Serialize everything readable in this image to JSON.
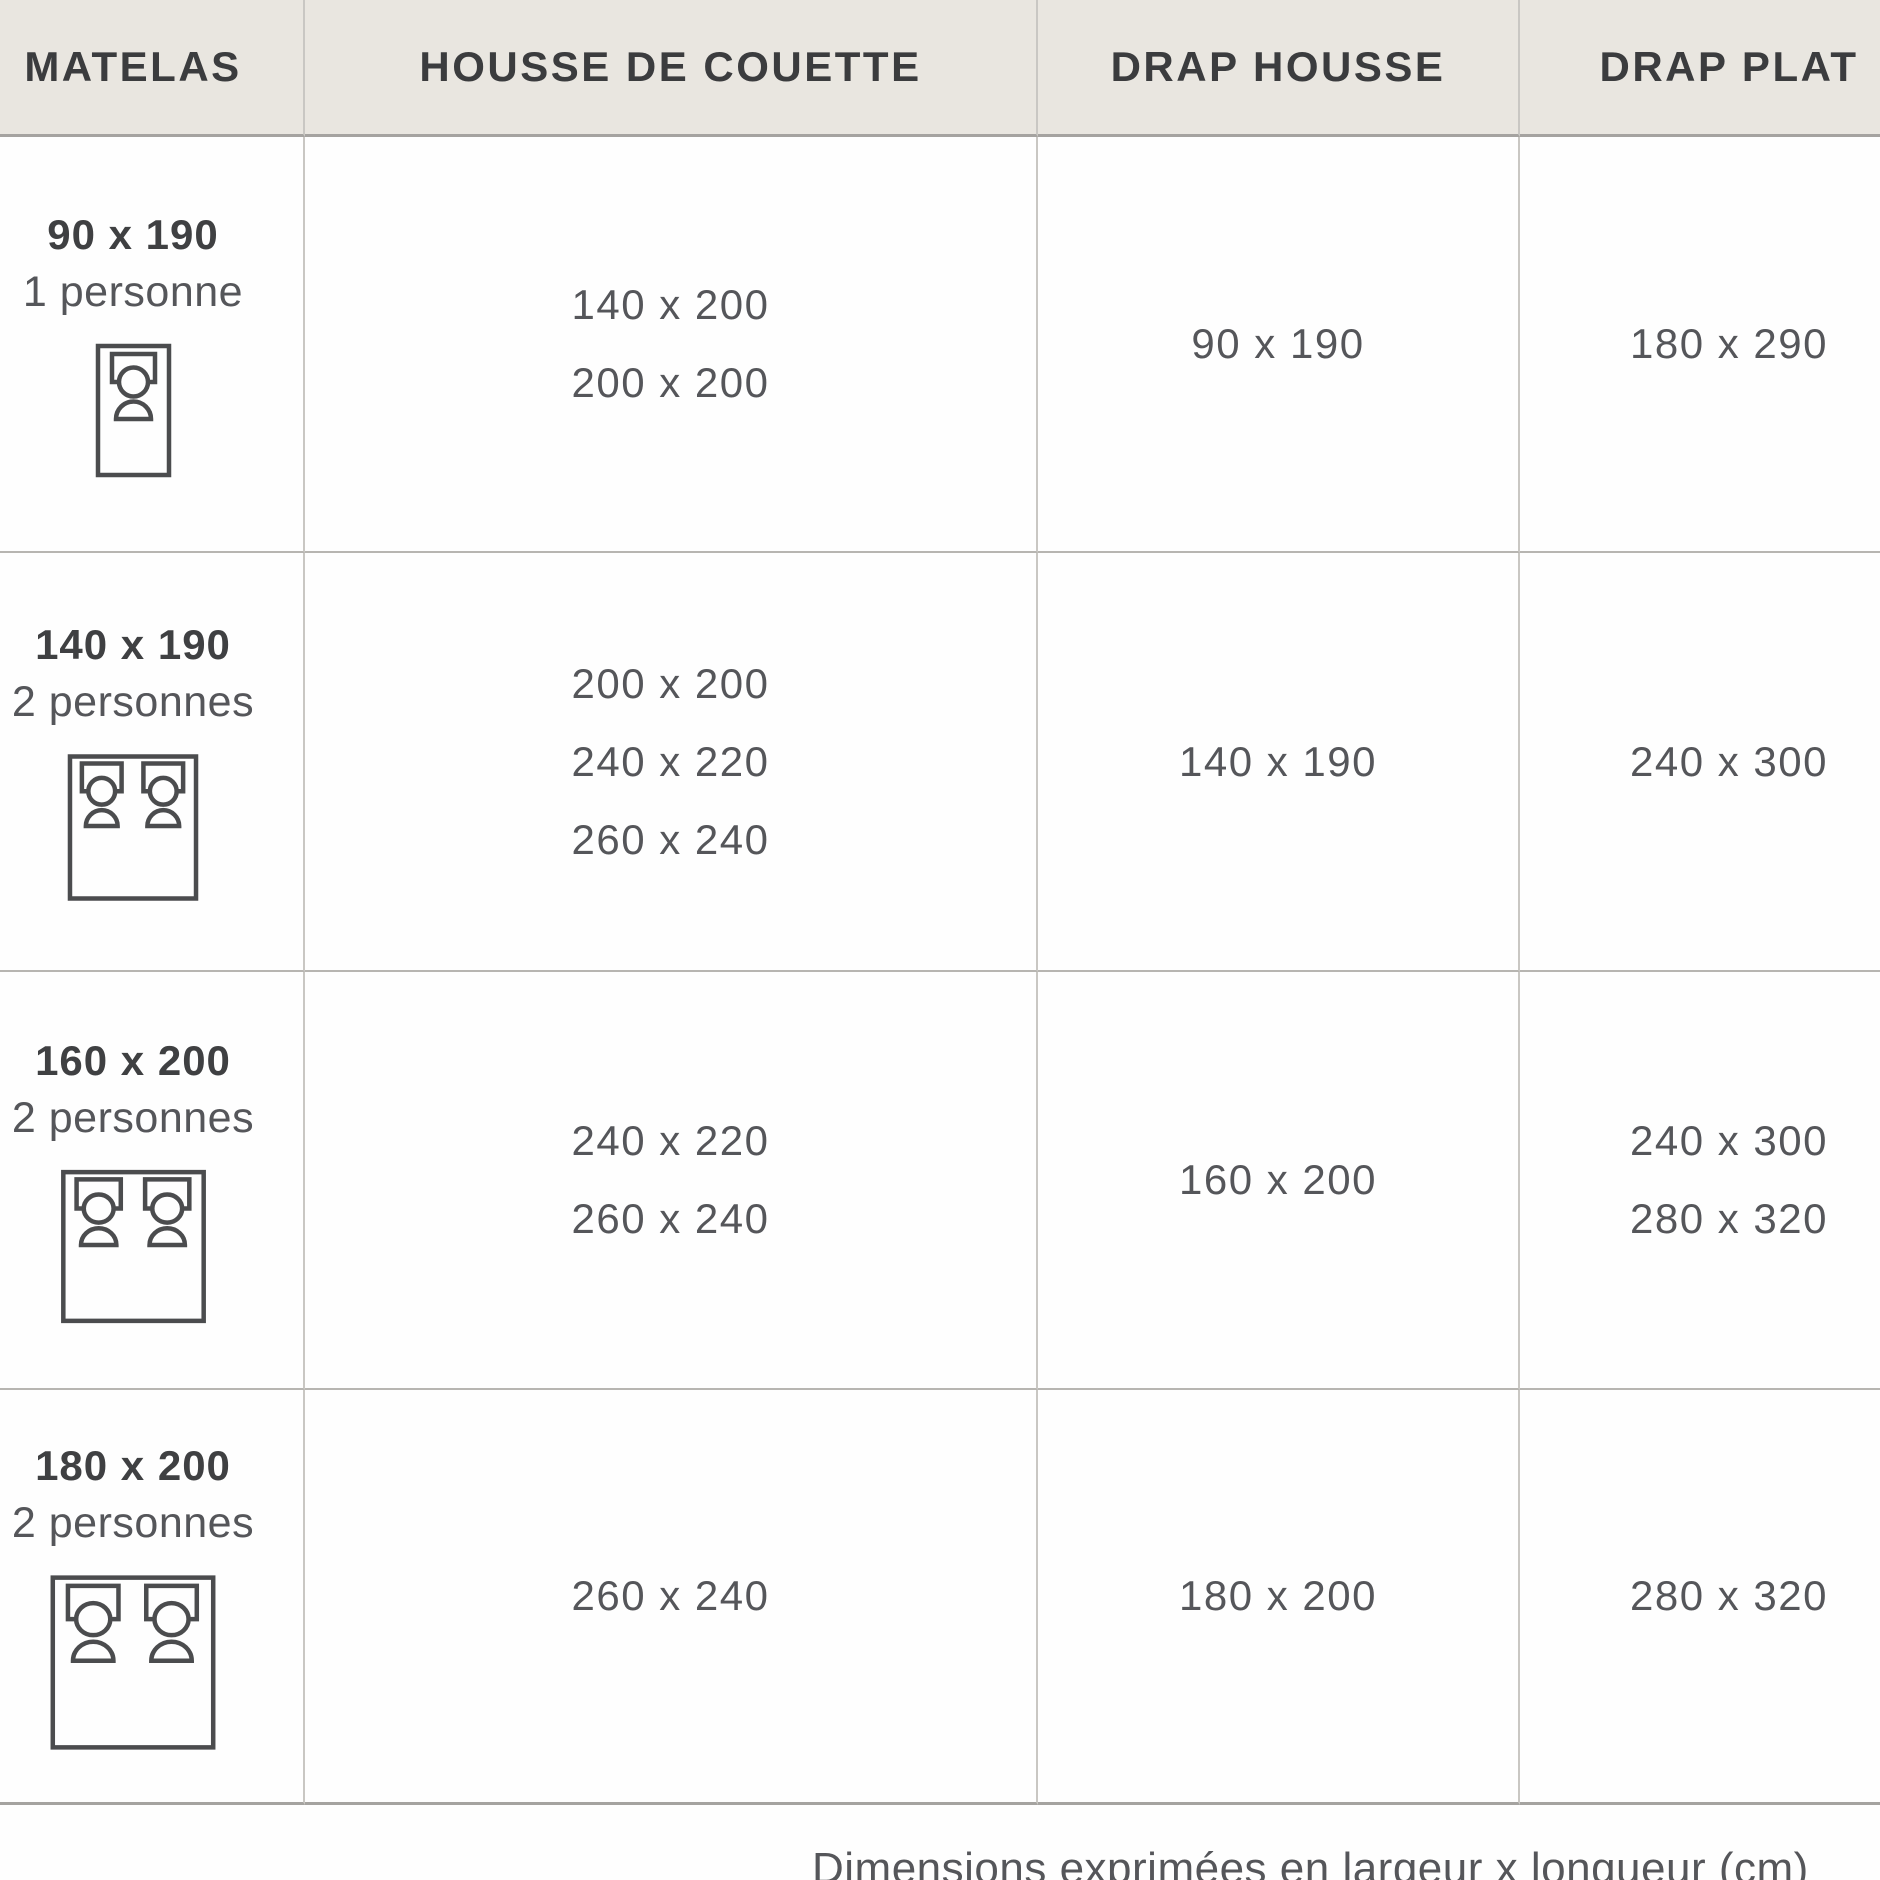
{
  "table": {
    "columns": [
      "MATELAS",
      "HOUSSE DE COUETTE",
      "DRAP HOUSSE",
      "DRAP PLAT"
    ],
    "rows": [
      {
        "mattress_size": "90 x 190",
        "persons": "1 personne",
        "bed_icon": "single-bed-icon",
        "housse_de_couette": [
          "140 x 200",
          "200 x 200"
        ],
        "drap_housse": [
          "90 x 190"
        ],
        "drap_plat": [
          "180 x 290"
        ]
      },
      {
        "mattress_size": "140 x 190",
        "persons": "2 personnes",
        "bed_icon": "double-bed-icon",
        "housse_de_couette": [
          "200 x 200",
          "240 x 220",
          "260 x 240"
        ],
        "drap_housse": [
          "140 x 190"
        ],
        "drap_plat": [
          "240 x 300"
        ]
      },
      {
        "mattress_size": "160 x 200",
        "persons": "2 personnes",
        "bed_icon": "double-bed-icon",
        "housse_de_couette": [
          "240 x 220",
          "260 x 240"
        ],
        "drap_housse": [
          "160 x 200"
        ],
        "drap_plat": [
          "240 x 300",
          "280 x 320"
        ]
      },
      {
        "mattress_size": "180 x 200",
        "persons": "2 personnes",
        "bed_icon": "double-bed-icon",
        "housse_de_couette": [
          "260 x 240"
        ],
        "drap_housse": [
          "180 x 200"
        ],
        "drap_plat": [
          "280 x 320"
        ]
      }
    ]
  },
  "footer": {
    "note": "Dimensions exprimées en largeur x longueur (cm)"
  },
  "colors": {
    "header_background": "#e9e6e0",
    "header_text": "#3b3c3e",
    "body_text": "#55565a",
    "grid_line": "#c9c7c3",
    "icon_stroke": "#4b4c4e"
  }
}
